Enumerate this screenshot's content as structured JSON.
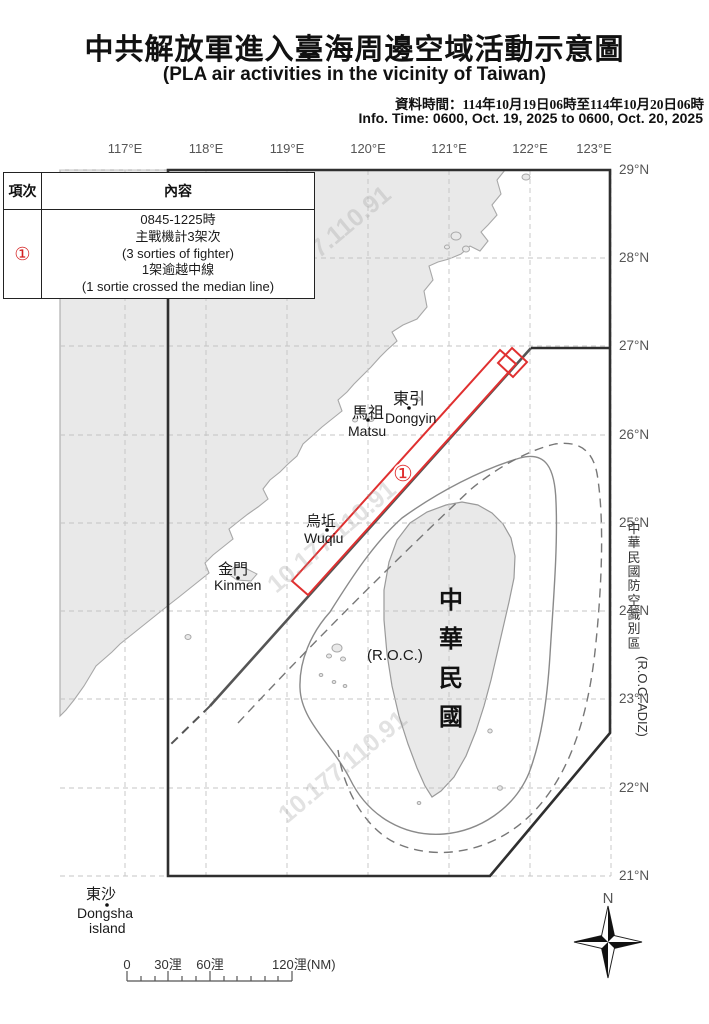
{
  "header": {
    "title_zh": "中共解放軍進入臺海周邊空域活動示意圖",
    "title_en": "(PLA air activities in the vicinity of Taiwan)",
    "info_zh": "資料時間：114年10月19日06時至114年10月20日06時",
    "info_en": "Info. Time: 0600, Oct. 19, 2025 to 0600, Oct. 20, 2025"
  },
  "legend_table": {
    "header_item": "項次",
    "header_content": "內容",
    "rows": [
      {
        "no": "①",
        "lines": [
          "0845-1225時",
          "主戰機計3架次",
          "(3 sorties of fighter)",
          "1架逾越中線",
          "(1 sortie crossed the median line)"
        ]
      }
    ]
  },
  "map": {
    "lon_labels": [
      "117°E",
      "118°E",
      "119°E",
      "120°E",
      "121°E",
      "122°E",
      "123°E"
    ],
    "lat_labels": [
      "29°N",
      "28°N",
      "27°N",
      "26°N",
      "25°N",
      "24°N",
      "23°N",
      "22°N",
      "21°N"
    ],
    "places": {
      "dongyin_zh": "東引",
      "dongyin_en": "Dongyin",
      "mazu_zh": "馬祖",
      "mazu_en": "Matsu",
      "wuqiu_zh": "烏坵",
      "wuqiu_en": "Wuqiu",
      "kinmen_zh": "金門",
      "kinmen_en": "Kinmen",
      "dongsha_zh": "東沙",
      "dongsha_en": "Dongsha",
      "dongsha_en2": "island",
      "roc_paren": "(R.O.C.)"
    },
    "taiwan_vertical": [
      "中",
      "華",
      "民",
      "國"
    ],
    "adiz_vertical": [
      "中",
      "華",
      "民",
      "國",
      "防",
      "空",
      "識",
      "別",
      "區"
    ],
    "adiz_latin": "(R.O.C. ADIZ)",
    "activity_marker": "①",
    "compass_north": "N",
    "scale_labels": {
      "zero": "0",
      "d30": "30浬",
      "d60": "60浬",
      "d120": "120浬(NM)"
    },
    "watermark": "10.177.110.91",
    "colors": {
      "activity_red": "#e03030",
      "adiz_line": "#2f2f2f",
      "median_line": "#555555",
      "land_fill": "#e9e9e9"
    }
  }
}
